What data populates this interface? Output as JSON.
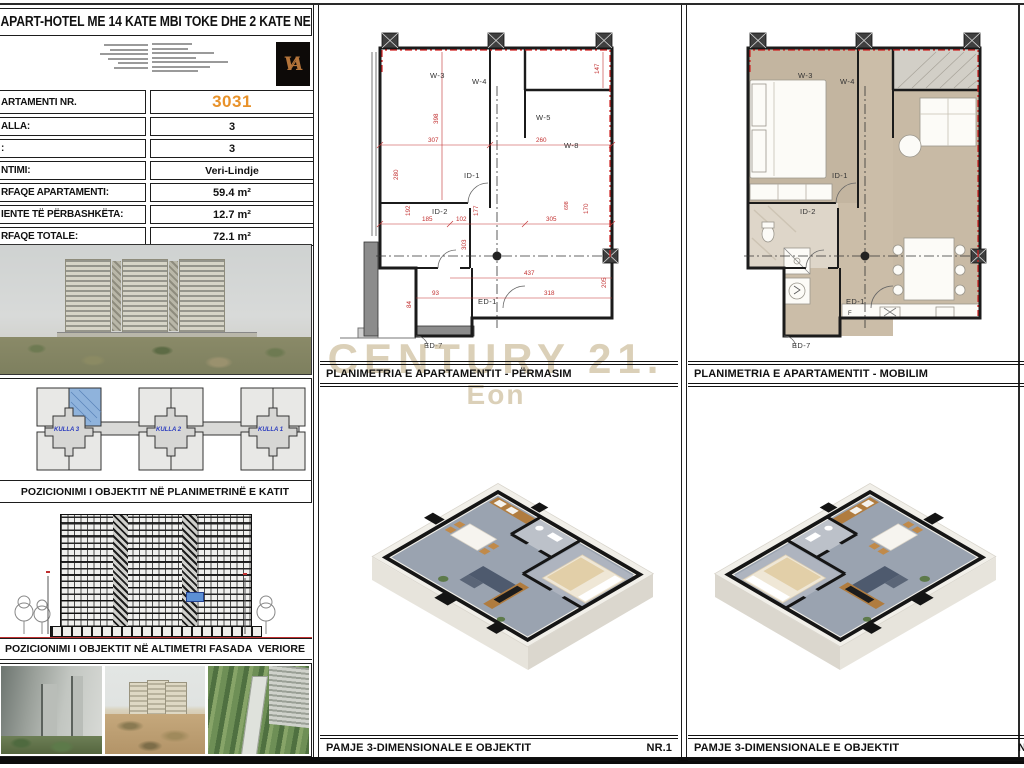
{
  "sheet": {
    "title": "APART-HOTEL ME 14 KATE MBI TOKE DHE 2 KATE NENTOKE",
    "logo_monogram": "VA",
    "accent_orange": "#e8922a",
    "dimension_red": "#c23030"
  },
  "watermark": {
    "line1": "CENTURY 21.",
    "line2": "Eon",
    "color": "#bda97e"
  },
  "info_table": {
    "rows": [
      {
        "label": "ARTAMENTI NR.",
        "value": "3031"
      },
      {
        "label": "ALLA:",
        "value": "3"
      },
      {
        "label": ":",
        "value": "3"
      },
      {
        "label": "NTIMI:",
        "value": "Veri-Lindje"
      },
      {
        "label": "RFAQE APARTAMENTI:",
        "value": "59.4 m²"
      },
      {
        "label": "IENTE TË PËRBASHKËTA:",
        "value": "12.7 m²"
      },
      {
        "label": "RFAQE TOTALE:",
        "value": "72.1 m²"
      }
    ]
  },
  "site_plan": {
    "caption": "POZICIONIMI I OBJEKTIT NË PLANIMETRINË E KATIT",
    "compass": "W",
    "towers": [
      "KULLA 3",
      "KULLA 2",
      "KULLA 1"
    ],
    "highlight_blue": "#7fa9d9"
  },
  "elevation": {
    "caption": "POZICIONIMI I OBJEKTIT NË ALTIMETRI FASADA  VERIORE"
  },
  "plans": {
    "measure": {
      "caption": "PLANIMETRIA E APARTAMENTIT - PËRMASIM",
      "rooms": {
        "w3": "W-3",
        "w4": "W-4",
        "w5": "W-5",
        "w8": "W-8",
        "id1": "ID-1",
        "id2": "ID-2",
        "ed1": "ED-1",
        "ed7": "ED-7"
      },
      "dims": {
        "d307": "307",
        "d260": "260",
        "d147": "147",
        "d398": "398",
        "d192": "192",
        "d185": "185",
        "d102": "102",
        "d177": "177",
        "d305": "305",
        "d170": "170",
        "d698": "698",
        "d437": "437",
        "d318": "318",
        "d205": "205",
        "d93": "93",
        "d84": "84",
        "d280": "280",
        "d303": "303"
      }
    },
    "furnished": {
      "caption": "PLANIMETRIA E APARTAMENTIT - MOBILIM",
      "rooms": {
        "w3": "W-3",
        "w4": "W-4",
        "id1": "ID-1",
        "id2": "ID-2",
        "ed1": "ED-1",
        "ed7": "ED-7",
        "f": "F"
      }
    }
  },
  "views": {
    "left": {
      "caption": "PAMJE 3-DIMENSIONALE E OBJEKTIT",
      "number": "NR.1"
    },
    "right": {
      "caption": "PAMJE 3-DIMENSIONALE E OBJEKTIT",
      "number": "N"
    }
  }
}
